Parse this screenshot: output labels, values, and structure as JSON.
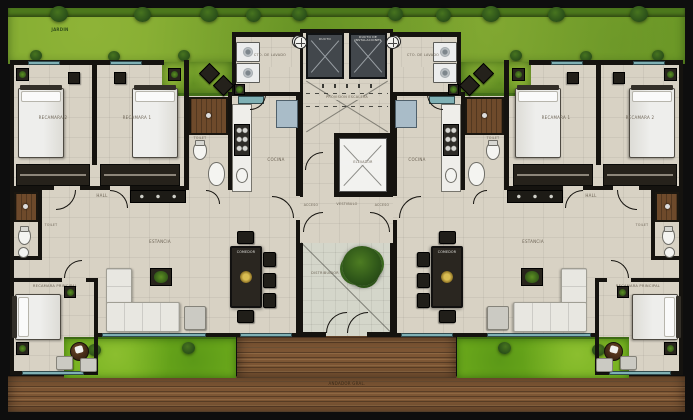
{
  "plan": {
    "type": "residential-floor-plan",
    "units": 2,
    "mirrored": true,
    "colors": {
      "garden_green": "#79a52b",
      "hedge_green": "#4d781c",
      "grass_green": "#72b01d",
      "floor_beige": "#d8d2c4",
      "courtyard_gray": "#d4d6ca",
      "deck_wood": "#7d5634",
      "shower_wood": "#6e4a2b",
      "wall_black": "#15130f",
      "window_teal": "#7fb0b4",
      "shaft_gray": "#42474c",
      "table_gold": "#d9bc52"
    },
    "labels": {
      "garden": "JARDIN",
      "bedroom1": "RECAMARA 1",
      "bedroom2": "RECAMARA 2",
      "master_bedroom": "RECAMARA PRINCIPAL",
      "toilet": "TOILET",
      "kitchen": "COCINA",
      "dining": "COMEDOR",
      "living": "ESTANCIA",
      "hall": "HALL",
      "laundry": "CTO. DE LAVADO",
      "duct_small": "DUCTO",
      "duct_large": "DUCTO DE INSTALACIONES",
      "stair_provision": "PROVISION ESCALERA",
      "elevator": "ELEVADOR",
      "vestibule": "VESTIBULO",
      "access": "ACCESO",
      "courtyard": "DISTRIBUIDOR",
      "walkway": "ANDADOR GRAL."
    }
  }
}
